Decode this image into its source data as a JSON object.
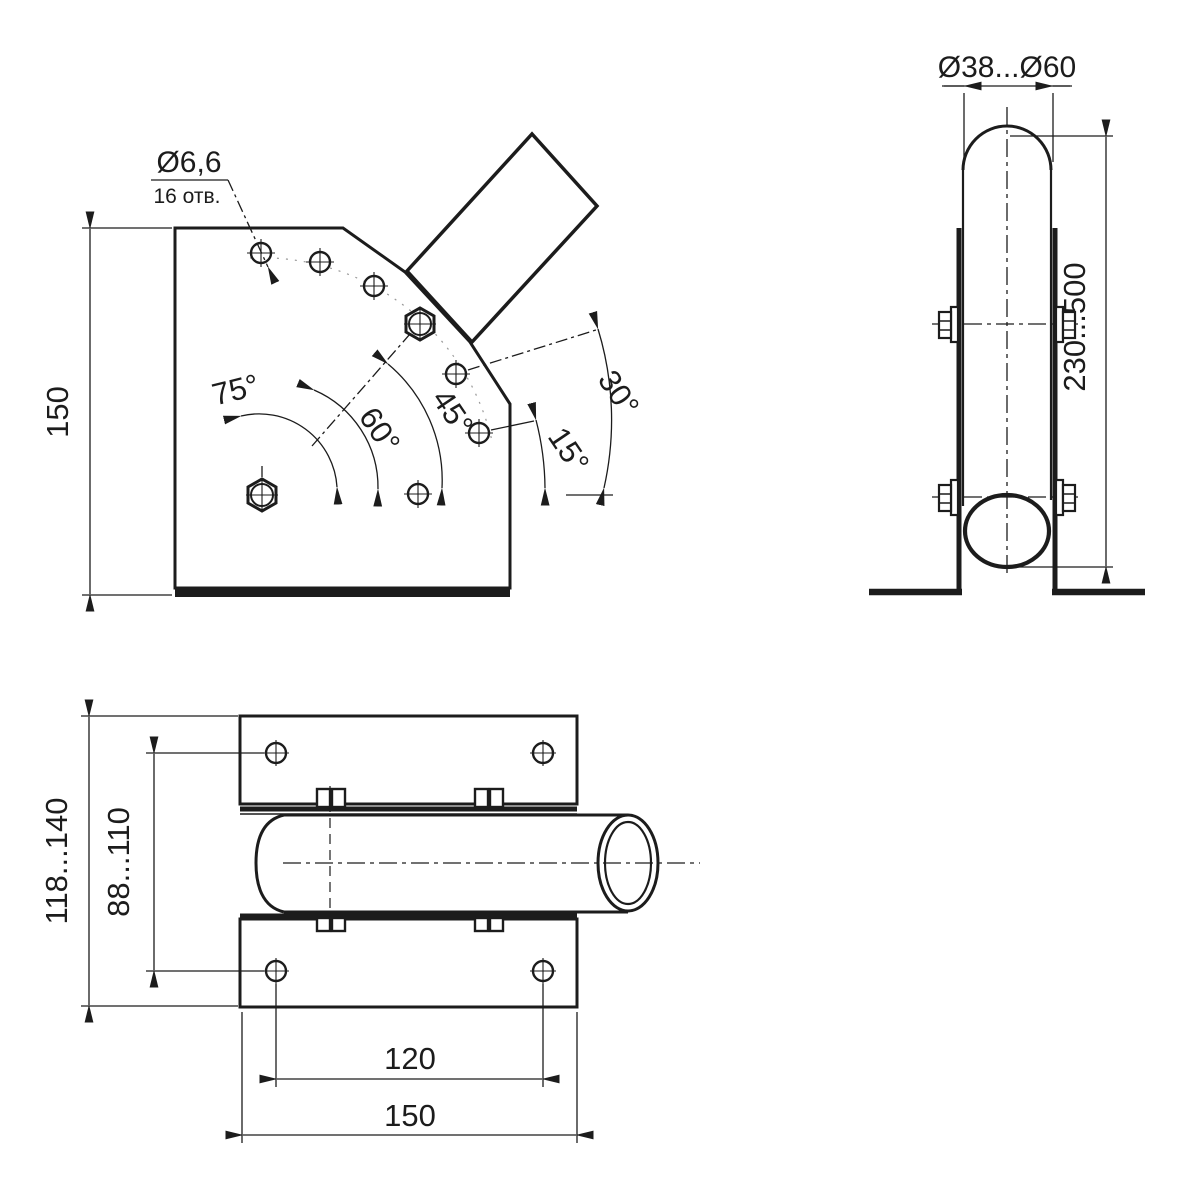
{
  "colors": {
    "background": "#ffffff",
    "line": "#1c1c1c"
  },
  "views": {
    "side_view": {
      "plate_height": "150",
      "hole_diameter": "Ø6,6",
      "hole_count": "16 отв.",
      "angles": {
        "a75": "75°",
        "a60": "60°",
        "a45": "45°",
        "a30": "30°",
        "a15": "15°"
      }
    },
    "front_view": {
      "pole_diameter_range": "Ø38...Ø60",
      "clamp_height_range": "230...500"
    },
    "top_view": {
      "overall_width_range": "118...140",
      "hole_rows_range": "88...110",
      "hole_spacing": "120",
      "plate_length": "150"
    }
  }
}
